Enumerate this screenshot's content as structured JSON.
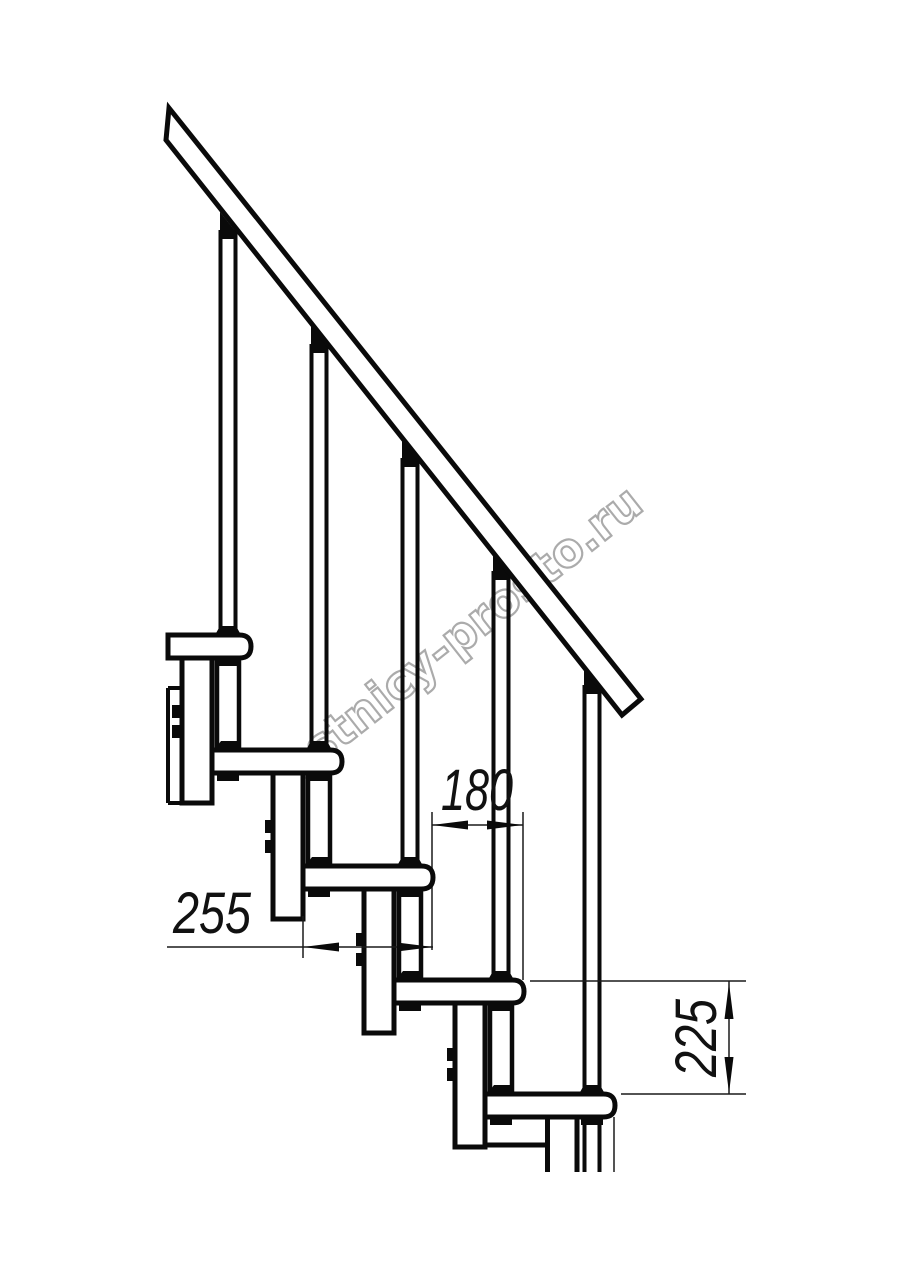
{
  "watermark": {
    "text": "lestnicy-prosto.ru",
    "color": "#ababab"
  },
  "dimensions": {
    "step_run": "180",
    "tread_depth": "255",
    "step_rise": "225"
  },
  "drawing": {
    "line_color": "#0a0a0a",
    "background": "#ffffff"
  }
}
